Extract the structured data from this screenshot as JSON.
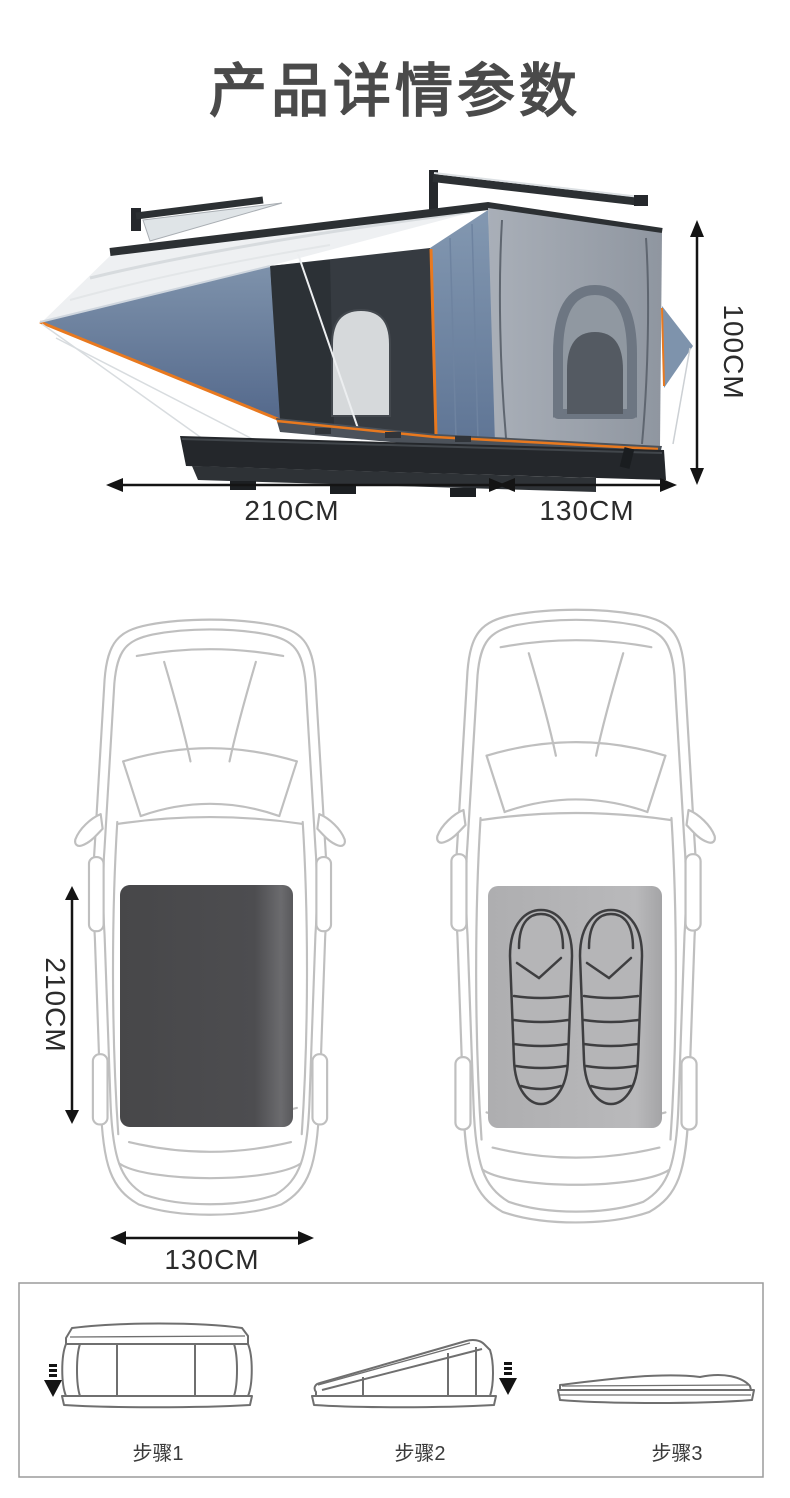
{
  "title": "产品详情参数",
  "tent": {
    "dims": {
      "length": "210CM",
      "side": "130CM",
      "height": "100CM"
    }
  },
  "roof": {
    "length": "210CM",
    "width": "130CM"
  },
  "steps": {
    "items": [
      {
        "label": "步骤1"
      },
      {
        "label": "步骤2"
      },
      {
        "label": "步骤3"
      }
    ]
  },
  "colors": {
    "title_text": "#4a4a4a",
    "dimension_text": "#2b2b2b",
    "arrow_black": "#141414",
    "car_outline": "#bfbfbf",
    "tent_footprint_dark": "#4b4b4d",
    "mattress_pad_gray": "#b5b5b7",
    "sleeping_bag_line": "#3e3e40",
    "awning_blue": "#6e84a3",
    "trim_orange": "#e8791f",
    "tent_fabric_gray": "#9aa1ab",
    "frame_dark": "#2c3033",
    "steps_border": "#9b9b9b",
    "line_drawing": "#6f6f6f"
  }
}
